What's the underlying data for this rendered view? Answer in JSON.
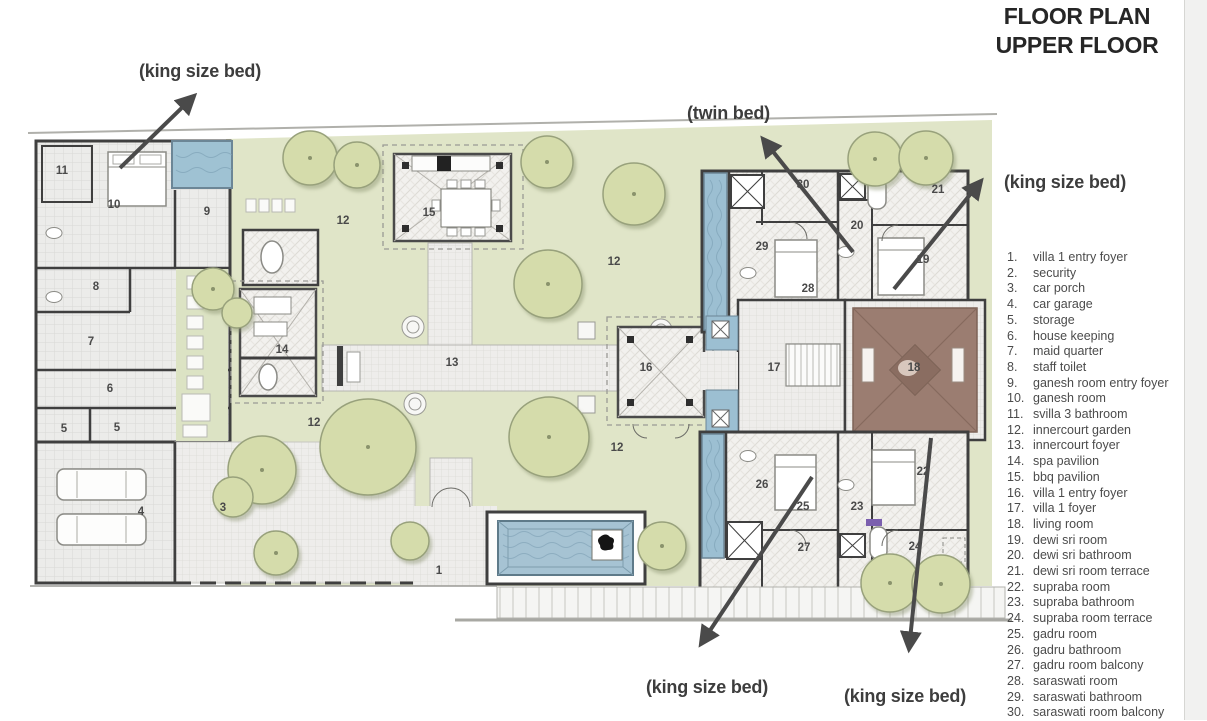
{
  "title": {
    "line1": "FLOOR PLAN",
    "line2": "UPPER FLOOR"
  },
  "legend": {
    "items": [
      {
        "num": "1",
        "label": "villa 1 entry foyer"
      },
      {
        "num": "2",
        "label": "security"
      },
      {
        "num": "3",
        "label": "car porch"
      },
      {
        "num": "4",
        "label": "car garage"
      },
      {
        "num": "5",
        "label": "storage"
      },
      {
        "num": "6",
        "label": "house keeping"
      },
      {
        "num": "7",
        "label": "maid quarter"
      },
      {
        "num": "8",
        "label": "staff toilet"
      },
      {
        "num": "9",
        "label": "ganesh room entry foyer"
      },
      {
        "num": "10",
        "label": "ganesh room"
      },
      {
        "num": "11",
        "label": "svilla 3 bathroom"
      },
      {
        "num": "12",
        "label": "innercourt garden"
      },
      {
        "num": "13",
        "label": "innercourt foyer"
      },
      {
        "num": "14",
        "label": "spa pavilion"
      },
      {
        "num": "15",
        "label": "bbq pavilion"
      },
      {
        "num": "16",
        "label": "villa 1 entry foyer"
      },
      {
        "num": "17",
        "label": "villa 1 foyer"
      },
      {
        "num": "18",
        "label": "living room"
      },
      {
        "num": "19",
        "label": "dewi sri room"
      },
      {
        "num": "20",
        "label": "dewi sri bathroom"
      },
      {
        "num": "21",
        "label": "dewi sri room terrace"
      },
      {
        "num": "22",
        "label": "supraba room"
      },
      {
        "num": "23",
        "label": "supraba bathroom"
      },
      {
        "num": "24",
        "label": "supraba room terrace"
      },
      {
        "num": "25",
        "label": "gadru room"
      },
      {
        "num": "26",
        "label": "gadru bathroom"
      },
      {
        "num": "27",
        "label": "gadru room balcony"
      },
      {
        "num": "28",
        "label": "saraswati room"
      },
      {
        "num": "29",
        "label": "saraswati bathroom"
      },
      {
        "num": "30",
        "label": "saraswati room balcony"
      }
    ]
  },
  "annotations": [
    {
      "text": "(king size bed)",
      "x": 139,
      "y": 61
    },
    {
      "text": "(twin bed)",
      "x": 687,
      "y": 103
    },
    {
      "text": "(king size bed)",
      "x": 1004,
      "y": 172
    },
    {
      "text": "(king size bed)",
      "x": 646,
      "y": 677
    },
    {
      "text": "(king size bed)",
      "x": 844,
      "y": 686
    }
  ],
  "arrows": [
    {
      "x1": 120,
      "y1": 168,
      "x2": 194,
      "y2": 96
    },
    {
      "x1": 853,
      "y1": 252,
      "x2": 763,
      "y2": 139
    },
    {
      "x1": 894,
      "y1": 289,
      "x2": 981,
      "y2": 181
    },
    {
      "x1": 812,
      "y1": 477,
      "x2": 701,
      "y2": 644
    },
    {
      "x1": 931,
      "y1": 438,
      "x2": 909,
      "y2": 649
    }
  ],
  "plan_labels": [
    {
      "n": "1",
      "x": 439,
      "y": 571
    },
    {
      "n": "3",
      "x": 223,
      "y": 508
    },
    {
      "n": "4",
      "x": 141,
      "y": 512
    },
    {
      "n": "5",
      "x": 64,
      "y": 429
    },
    {
      "n": "5",
      "x": 117,
      "y": 428
    },
    {
      "n": "6",
      "x": 110,
      "y": 389
    },
    {
      "n": "7",
      "x": 91,
      "y": 342
    },
    {
      "n": "8",
      "x": 96,
      "y": 287
    },
    {
      "n": "9",
      "x": 207,
      "y": 212
    },
    {
      "n": "10",
      "x": 114,
      "y": 205
    },
    {
      "n": "11",
      "x": 62,
      "y": 171
    },
    {
      "n": "12",
      "x": 343,
      "y": 221
    },
    {
      "n": "12",
      "x": 614,
      "y": 262
    },
    {
      "n": "12",
      "x": 314,
      "y": 423
    },
    {
      "n": "12",
      "x": 617,
      "y": 448
    },
    {
      "n": "13",
      "x": 452,
      "y": 363
    },
    {
      "n": "14",
      "x": 282,
      "y": 350
    },
    {
      "n": "15",
      "x": 429,
      "y": 213
    },
    {
      "n": "16",
      "x": 646,
      "y": 368
    },
    {
      "n": "17",
      "x": 774,
      "y": 368
    },
    {
      "n": "18",
      "x": 914,
      "y": 368
    },
    {
      "n": "19",
      "x": 923,
      "y": 260
    },
    {
      "n": "20",
      "x": 857,
      "y": 226
    },
    {
      "n": "21",
      "x": 938,
      "y": 190
    },
    {
      "n": "22",
      "x": 923,
      "y": 472
    },
    {
      "n": "23",
      "x": 857,
      "y": 507
    },
    {
      "n": "24",
      "x": 915,
      "y": 547
    },
    {
      "n": "25",
      "x": 803,
      "y": 507
    },
    {
      "n": "26",
      "x": 762,
      "y": 485
    },
    {
      "n": "27",
      "x": 804,
      "y": 548
    },
    {
      "n": "28",
      "x": 808,
      "y": 289
    },
    {
      "n": "29",
      "x": 762,
      "y": 247
    },
    {
      "n": "30",
      "x": 803,
      "y": 185
    }
  ],
  "colors": {
    "garden_green": "#e0e5c8",
    "tree_green": "#d5dcab",
    "pool_blue": "#a6c3d3",
    "wall_dark": "#3f3f3f",
    "roof_brown": "#9b7d71",
    "accent_purple": "#7b5fae",
    "text_dark": "#262626"
  }
}
